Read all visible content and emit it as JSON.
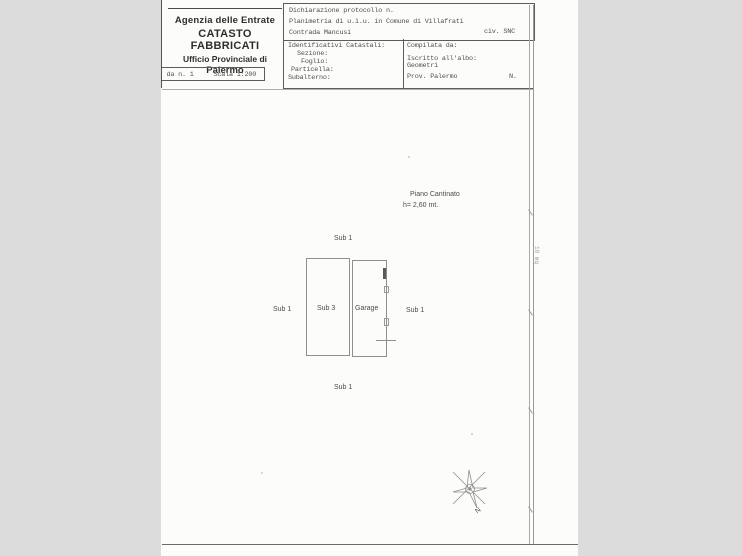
{
  "header": {
    "agency": {
      "line1": "Agenzia delle Entrate",
      "line2": "CATASTO FABBRICATI",
      "line3": "Ufficio Provinciale di",
      "line4": "Palermo"
    },
    "scheda": {
      "number": "da n. 1",
      "scale": "Scala 1:200"
    },
    "declaration": {
      "protocol": "Dichiarazione protocollo n.",
      "planimetry": "Planimetria di u.i.u. in Comune di Villafrati",
      "civ": "civ. SNC",
      "address": "Contrada Mancusi"
    },
    "identifiers": {
      "title": "Identificativi Catastali:",
      "section": "Sezione:",
      "sheet": "Foglio:",
      "parcel": "Particella:",
      "subaltern": "Subalterno:"
    },
    "compiler": {
      "title": "Compilata da:",
      "register": "Iscritto all'albo:",
      "register2": "Geometri",
      "province": "Prov. Palermo",
      "number_label": "N."
    }
  },
  "plan": {
    "floor_label": "Piano Cantinato",
    "height_label": "h=  2,60 mt.",
    "rooms": [
      {
        "name": "Sub 3"
      },
      {
        "name": "Garage"
      }
    ],
    "surround": {
      "top": "Sub 1",
      "left": "Sub 1",
      "right": "Sub 1",
      "bottom": "Sub 1"
    },
    "side_note": "10 mq",
    "compass_label": "N"
  },
  "colors": {
    "page": "#fcfcfa",
    "surround_gray": "#dcdcdc",
    "ink": "#4f4f4f",
    "plan_line": "#8f8f8f"
  }
}
